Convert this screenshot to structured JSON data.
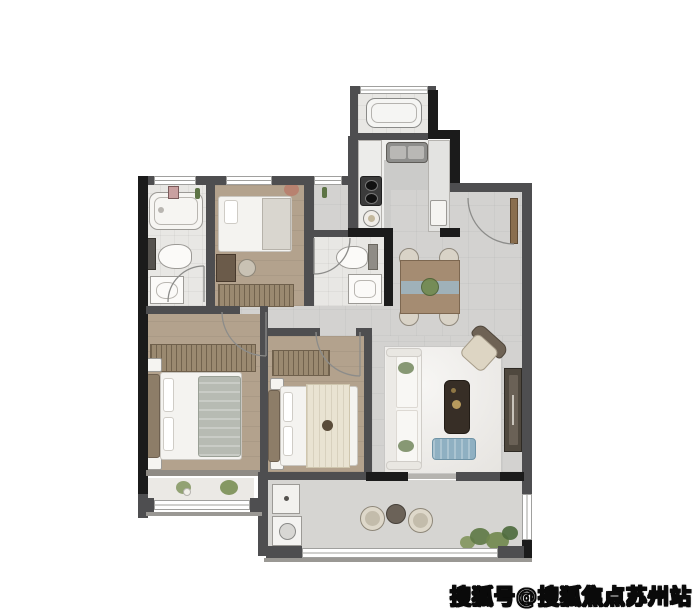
{
  "watermark": {
    "text": "搜狐号@搜狐焦点苏州站"
  },
  "palette": {
    "wall_gray": "#4e4e50",
    "wall_black": "#1b1b1b",
    "floor_wood": "#b3a28d",
    "floor_tile": "#e8e7e4",
    "floor_gray": "#d3d2d0",
    "floor_balcony": "#d6d5d2",
    "window_frame": "#a0a09e",
    "door_leaf": "#8a6e4e",
    "sofa_white": "#f5f4f1",
    "table_dark": "#372e26",
    "ottoman_blue": "#8fb0c2",
    "dining_wood": "#a58c72",
    "runner_blue": "#9db7c5",
    "wardrobe_tan": "#9a8970",
    "plant_green": "#72894f",
    "throw_gray": "#b7bbb3",
    "throw_cream": "#e9e3d2",
    "headboard_tan": "#8d7d68"
  },
  "legend": {
    "rooms": [
      "utility balcony",
      "kitchen",
      "entry",
      "dining area",
      "living room",
      "bathroom 1",
      "bathroom 2",
      "bedroom 3",
      "bedroom 2",
      "master bedroom",
      "bay balcony",
      "south balcony"
    ],
    "furniture": [
      "washing machine",
      "kitchen sink",
      "stove",
      "bathtub",
      "toilet",
      "wash basin",
      "single bed",
      "desk",
      "desk chair",
      "wardrobe",
      "double bed",
      "nightstand",
      "dining table",
      "dining chair",
      "sofa",
      "coffee table",
      "blue ottoman",
      "armchair",
      "tv cabinet",
      "laundry counter",
      "outdoor chair",
      "outdoor table",
      "plants"
    ]
  }
}
